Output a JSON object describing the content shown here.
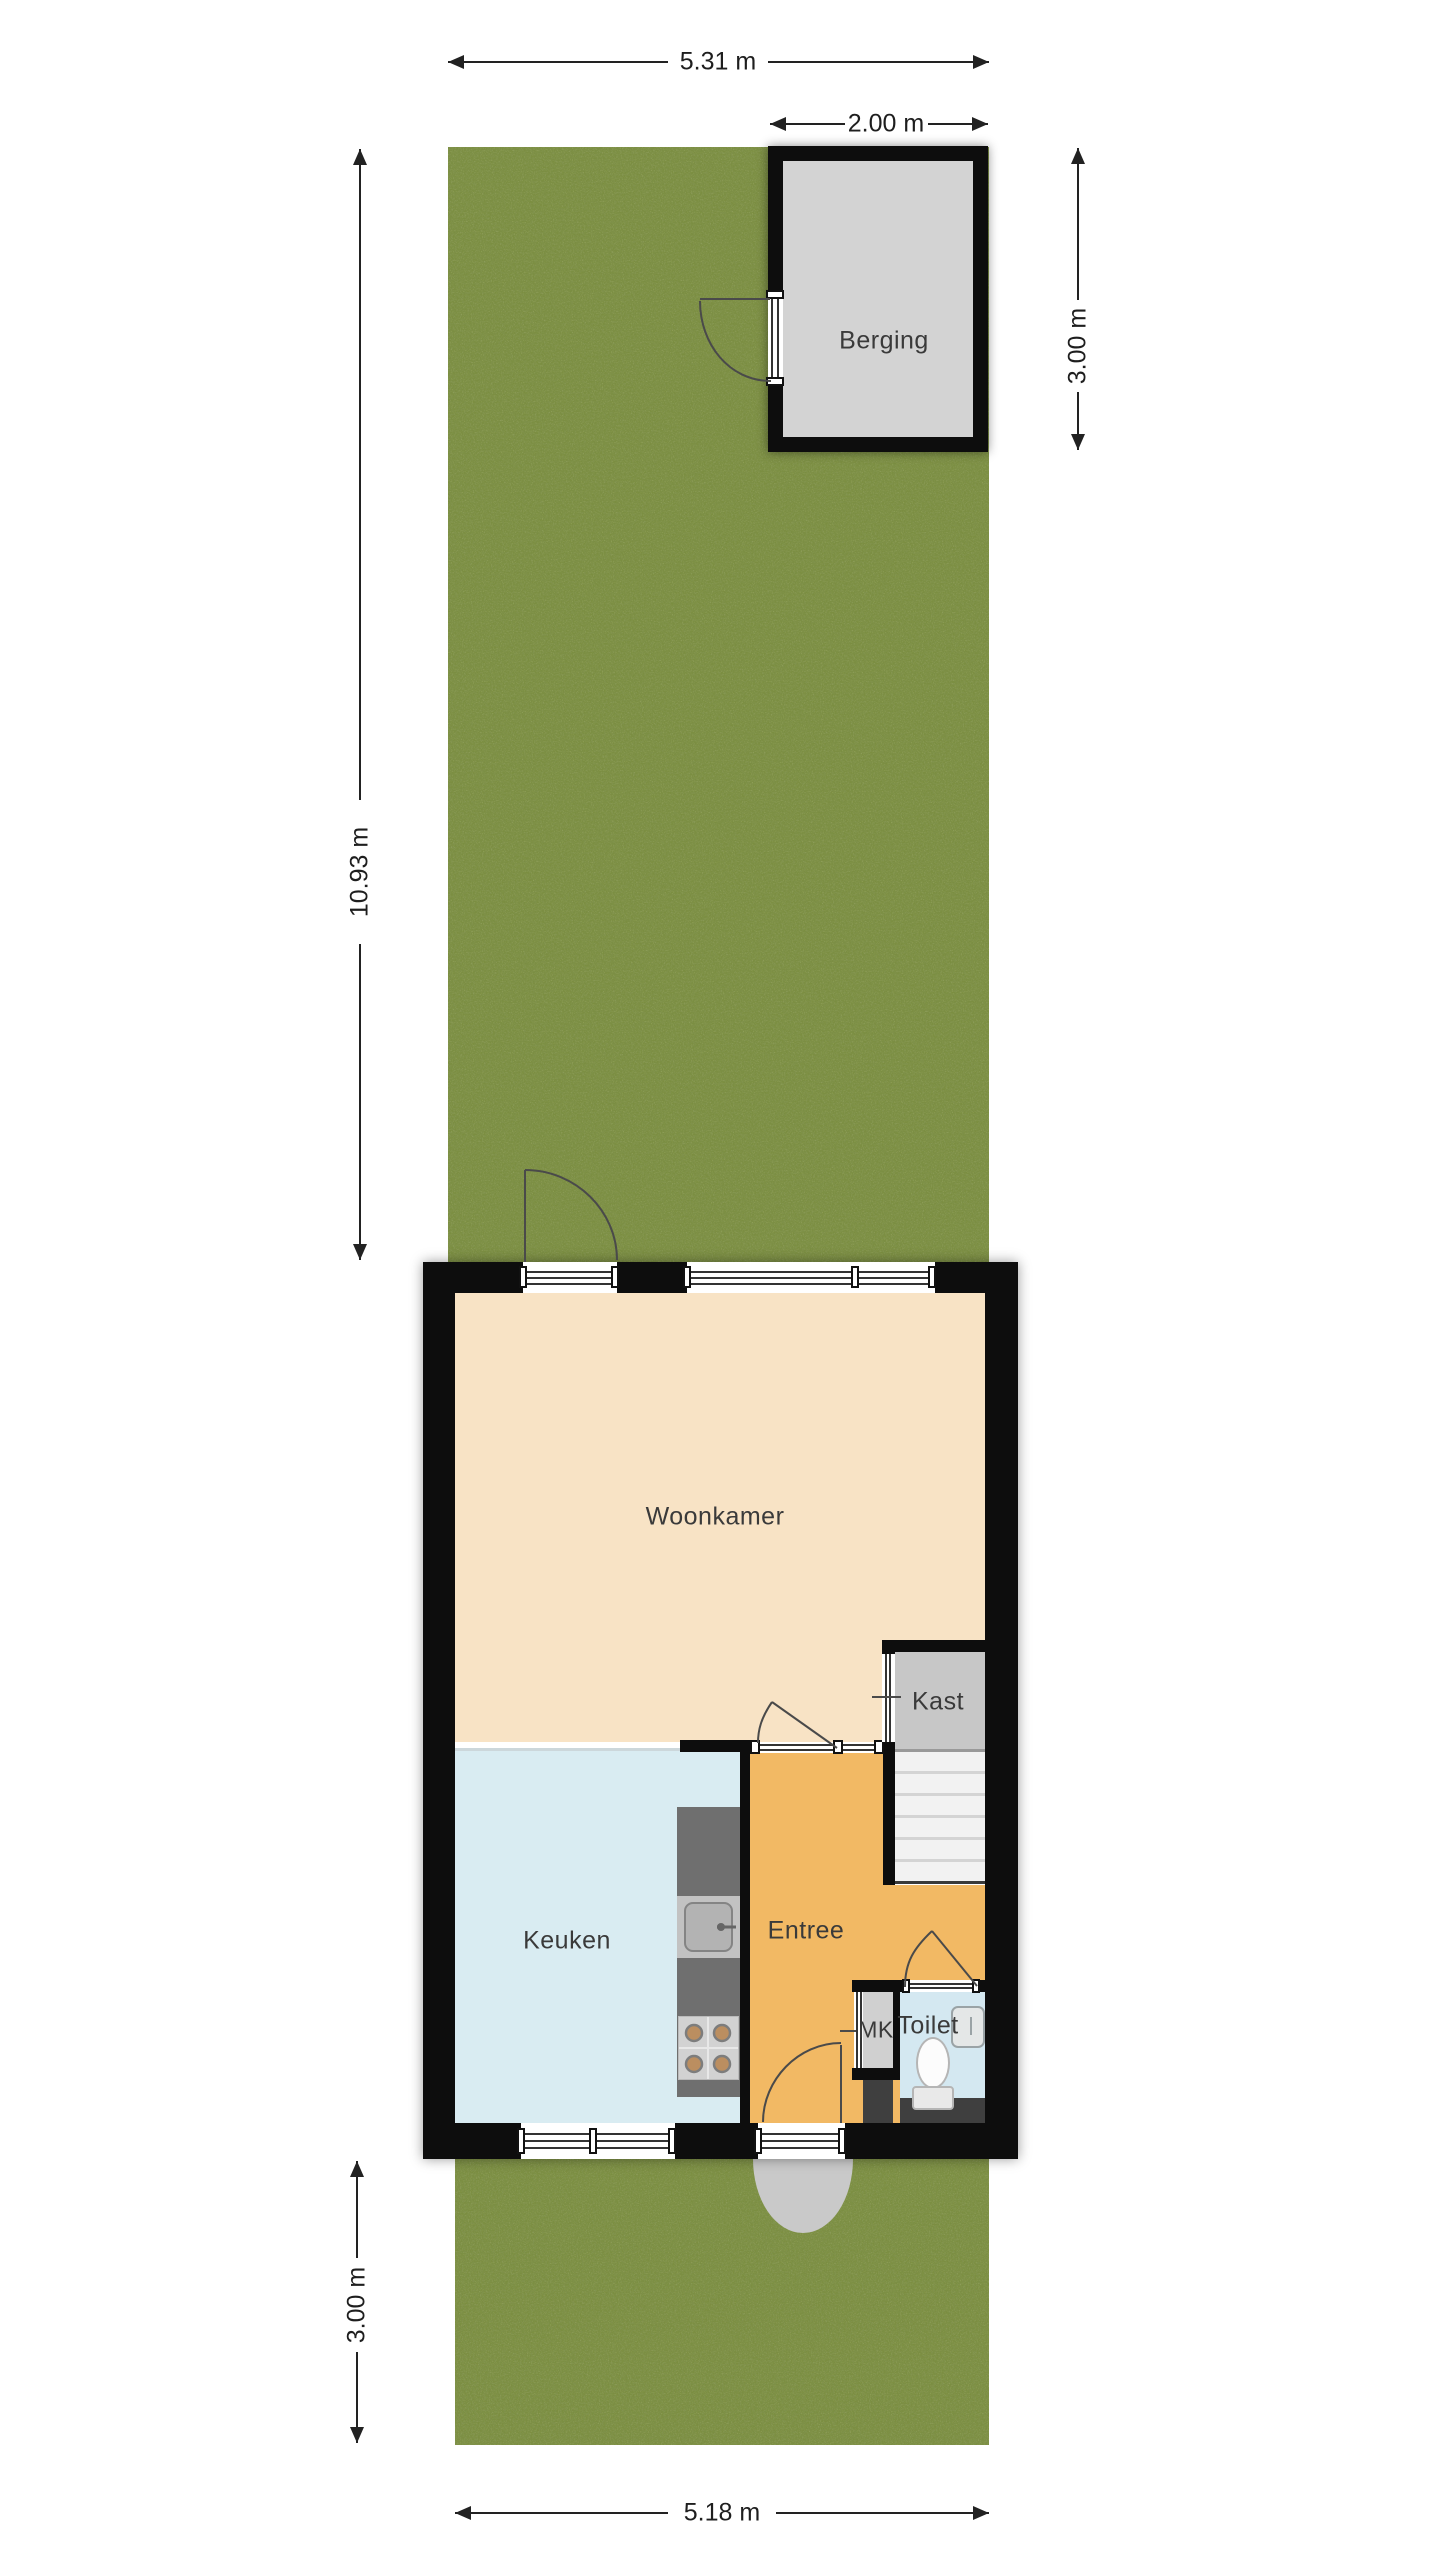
{
  "rooms": {
    "woonkamer": "Woonkamer",
    "keuken": "Keuken",
    "entree": "Entree",
    "kast": "Kast",
    "mk": "MK",
    "toilet": "Toilet",
    "berging": "Berging"
  },
  "dimensions": {
    "garden_width": "5.31 m",
    "shed_width": "2.00 m",
    "shed_depth": "3.00 m",
    "garden_depth": "10.93 m",
    "front_garden_depth": "3.00 m",
    "house_width": "5.18 m"
  },
  "colors": {
    "wall": "#0d0d0d",
    "white": "#ffffff",
    "grass": "#7b8e41",
    "woonkamer": "#f8e3c5",
    "keuken": "#d9ecf2",
    "entree": "#f2b964",
    "toilet": "#d4e8f1",
    "kast": "#c7c7c7",
    "berging": "#d3d3d3",
    "counter": "#6f6f6f",
    "sink_outer": "#c2c2c2",
    "sink_inner": "#b3b3b3",
    "stove": "#d2d2d2",
    "burner": "#bb8e60",
    "dark_cell": "#3f3f3f",
    "porch": "#c9c9c9",
    "swing_line": "#4a4a4a",
    "dim_line": "#222222"
  }
}
